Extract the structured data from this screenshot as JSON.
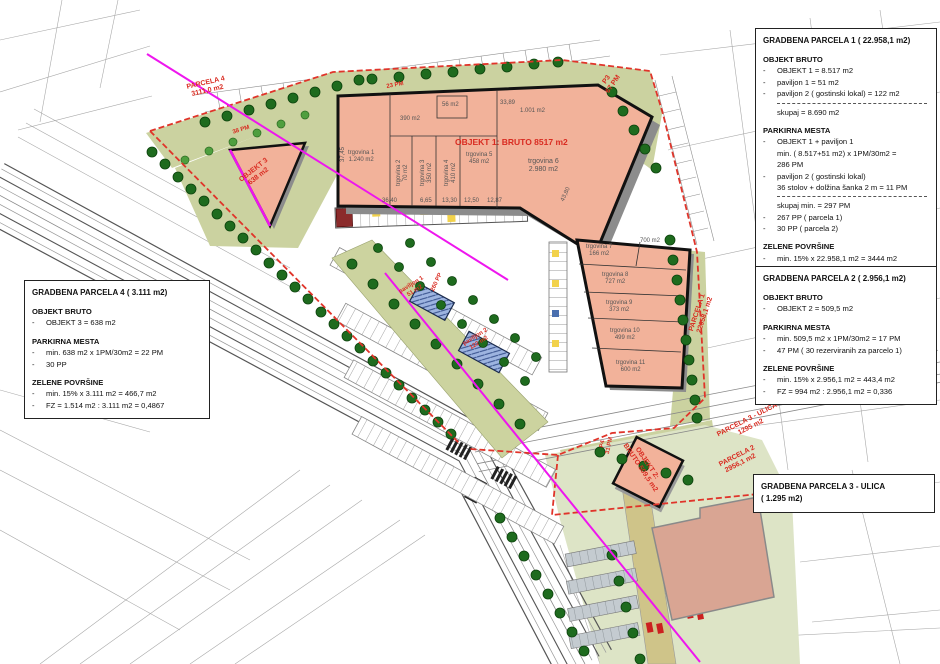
{
  "bullet": "-",
  "colors": {
    "building_fill": "#f2b29a",
    "existing_building_fill": "#d9a593",
    "green_area": "#cbd2a0",
    "pale_green": "#dde4c6",
    "tree": "#1e6b1e",
    "boundary_red": "#e0342a",
    "magenta_line": "#ee16ee",
    "red_label": "#d92b21",
    "pavilion_blue": "#9db4e0"
  },
  "boxes": {
    "parcel1": {
      "title": "GRADBENA PARCELA 1  ( 22.958,1 m2)",
      "s1_head": "OBJEKT BRUTO",
      "s1_items": [
        "OBJEKT 1 = 8.517 m2",
        "paviljon 1 = 51 m2",
        "paviljon 2  ( gostinski lokal)  = 122 m2"
      ],
      "s1_total": "skupaj = 8.690 m2",
      "s2_head": "PARKIRNA MESTA",
      "s2_item1a": "OBJEKT 1 + paviljon 1",
      "s2_item1b": "min.  ( 8.517+51 m2)  x 1PM/30m2 =",
      "s2_item1c": "286 PM",
      "s2_item2a": "paviljon 2  ( gostinski lokal)",
      "s2_item2b": "36 stolov + dolžina šanka 2 m = 11 PM",
      "s2_total": "skupaj min. = 297 PM",
      "s2_item3": "267 PP  ( parcela 1)",
      "s2_item4": "30 PP  ( parcela 2)",
      "s3_head": "ZELENE POVRŠINE",
      "s3_items": [
        "min. 15% x 22.958,1 m2 = 3444 m2",
        "FZ = 3446 m2 : 22.958,1 m2 = 0,15"
      ]
    },
    "parcel2": {
      "title": "GRADBENA PARCELA 2  ( 2.956,1 m2)",
      "s1_head": "OBJEKT BRUTO",
      "s1_items": [
        "OBJEKT 2 = 509,5 m2"
      ],
      "s2_head": "PARKIRNA MESTA",
      "s2_items": [
        "min. 509,5 m2 x 1PM/30m2 = 17 PM",
        "47 PM  ( 30 rezerviranih za parcelo 1)"
      ],
      "s3_head": "ZELENE POVRŠINE",
      "s3_items": [
        "min. 15% x 2.956,1 m2 = 443,4 m2",
        "FZ = 994 m2 : 2.956,1 m2 = 0,336"
      ]
    },
    "parcel4": {
      "title": "GRADBENA PARCELA 4  ( 3.111 m2)",
      "s1_head": "OBJEKT BRUTO",
      "s1_items": [
        "OBJEKT 3 = 638 m2"
      ],
      "s2_head": "PARKIRNA MESTA",
      "s2_items": [
        "min. 638 m2 x 1PM/30m2 = 22 PM",
        "30 PP"
      ],
      "s3_head": "ZELENE POVRŠINE",
      "s3_items": [
        "min. 15% x 3.111 m2 = 466,7 m2",
        "FZ = 1.514 m2 : 3.111 m2 = 0,4867"
      ]
    },
    "parcel3": {
      "title1": "GRADBENA PARCELA 3 - ULICA",
      "title2": "( 1.295 m2)"
    }
  },
  "labels": {
    "parcela4": [
      "PARCELA 4",
      "3111,0 m2"
    ],
    "p3": [
      "P3",
      "67 PM"
    ],
    "parcela1": [
      "PARCELA 1",
      "22958,1 m2"
    ],
    "parcela3": [
      "PARCELA 3 - ULICA",
      "1295 m2"
    ],
    "parcela2": [
      "PARCELA 2",
      "2956,1 m2"
    ],
    "objekt3": [
      "OBJEKT 3",
      "638 m2"
    ],
    "objekt1": "OBJEKT 1: BRUTO 8517 m2",
    "trgovina6": [
      "trgovina 6",
      "2.980 m2"
    ],
    "objekt2": [
      "OBJEKT 2:",
      "BRUTO 509,5 m2"
    ],
    "paviljon1": [
      "paviljon 1",
      "51 m2"
    ],
    "paviljon2": [
      "paviljon 2",
      "122 m2"
    ],
    "pp260": "260 PP",
    "p4": [
      "P4",
      "31 PM"
    ],
    "pm38": "38 PM",
    "pm23": "23 PM",
    "trg1": [
      "trgovina 1",
      "1.240 m2"
    ],
    "trg2": [
      "trgovina 2",
      "70 m2"
    ],
    "trg3": [
      "trgovina 3",
      "350 m2"
    ],
    "trg4": [
      "trgovina 4",
      "410 m2"
    ],
    "trg5": [
      "trgovina 5",
      "458 m2"
    ],
    "a390": "390 m2",
    "a56": "56 m2",
    "a1001": "1.001 m2",
    "trg7": [
      "trgovina 7",
      "166 m2"
    ],
    "a700": "700 m2",
    "trg8": [
      "trgovina 8",
      "727 m2"
    ],
    "trg9": [
      "trgovina 9",
      "373 m2"
    ],
    "trg10": [
      "trgovina 10",
      "499 m2"
    ],
    "trg11": [
      "trgovina 11",
      "600 m2"
    ],
    "dims": {
      "d1": "36,40",
      "d2": "6,65",
      "d3": "13,30",
      "d4": "12,50",
      "d5": "12,87",
      "d6": "37,45",
      "d7": "33,89",
      "d8": "43,80"
    }
  }
}
